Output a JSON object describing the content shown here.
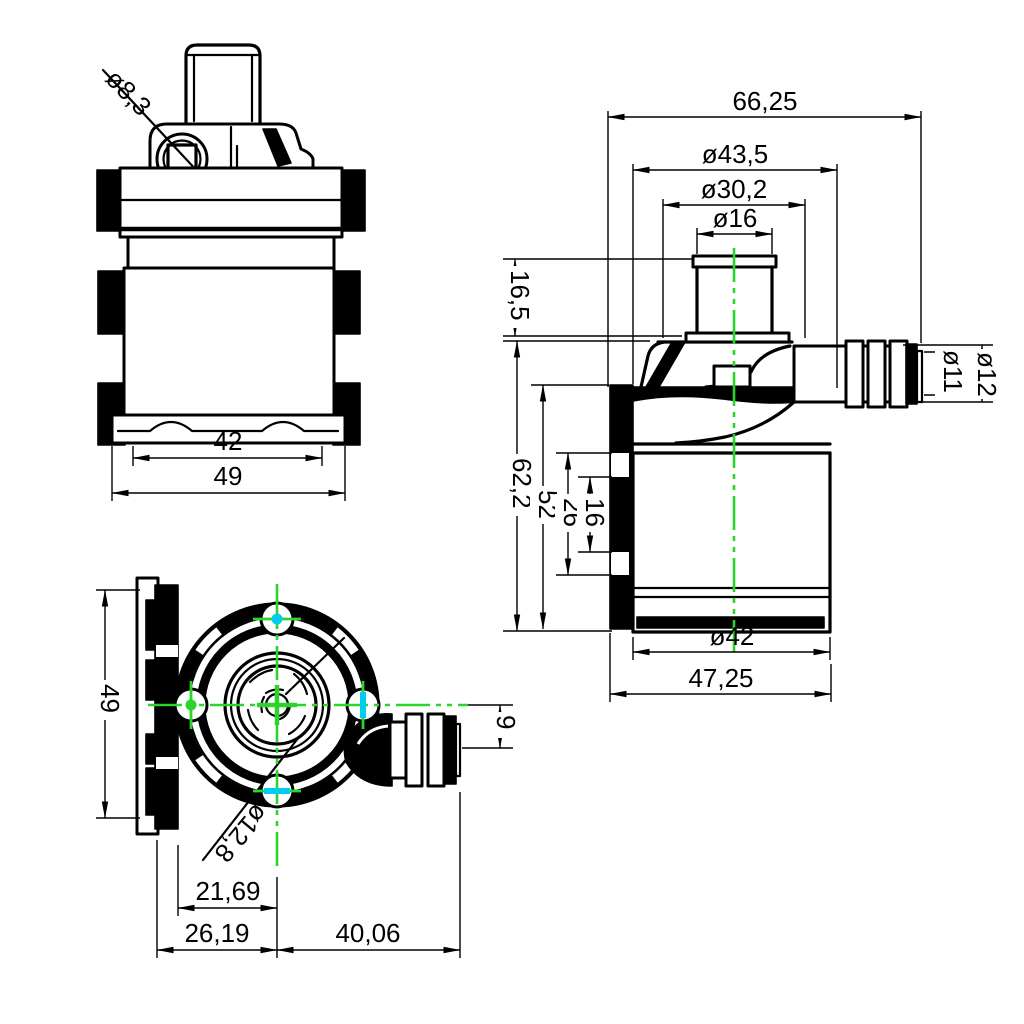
{
  "drawing": {
    "colors": {
      "centerline_green": "#2bd42b",
      "accent_cyan": "#00cdee",
      "ink": "#000000",
      "paper": "#ffffff"
    },
    "front_view": {
      "hole_dia": "ø8,3",
      "inner_width": "42",
      "outer_width": "49"
    },
    "side_view": {
      "overall_width": "66,25",
      "head_dia": "ø43,5",
      "neck_dia": "ø30,2",
      "inlet_dia": "ø16",
      "inlet_height": "16,5",
      "body_height": "62,2",
      "flange_height": "52",
      "slot_span_outer": "26",
      "slot_span_inner": "16",
      "motor_dia": "ø42",
      "body_width": "47,25",
      "barb_inner_dia": "ø11",
      "barb_outer_dia": "ø12"
    },
    "top_view": {
      "flange_height": "49",
      "outlet_offset": "9",
      "outlet_dia": "ø12,8",
      "center_to_flange_step": "21,69",
      "center_to_flange_edge": "26,19",
      "center_to_barb_end": "40,06"
    }
  }
}
